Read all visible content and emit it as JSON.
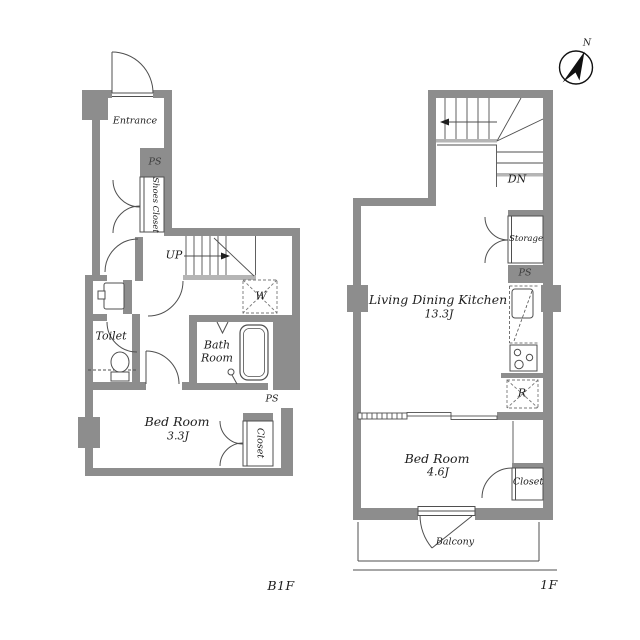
{
  "colors": {
    "wall": "#8d8d8d",
    "line": "#4f4f4f",
    "light_line": "#b5b5b5",
    "text": "#1e1e1e",
    "background": "#ffffff"
  },
  "compass": {
    "north_label": "N"
  },
  "b1f": {
    "floor_label": "B1F",
    "entrance": "Entrance",
    "ps_upper": "PS",
    "shoes_closet": "Shoes Closet",
    "up": "UP",
    "washer": "W",
    "toilet": "Toilet",
    "bathroom": "Bath Room",
    "bedroom_name": "Bed Room",
    "bedroom_size": "3.3J",
    "ps_lower": "PS",
    "closet": "Closet"
  },
  "f1": {
    "floor_label": "1F",
    "dn": "DN",
    "storage": "Storage",
    "ps": "PS",
    "ldk_name": "Living Dining Kitchen",
    "ldk_size": "13.3J",
    "fridge": "R",
    "bedroom_name": "Bed Room",
    "bedroom_size": "4.6J",
    "closet": "Closet",
    "balcony": "Balcony"
  }
}
